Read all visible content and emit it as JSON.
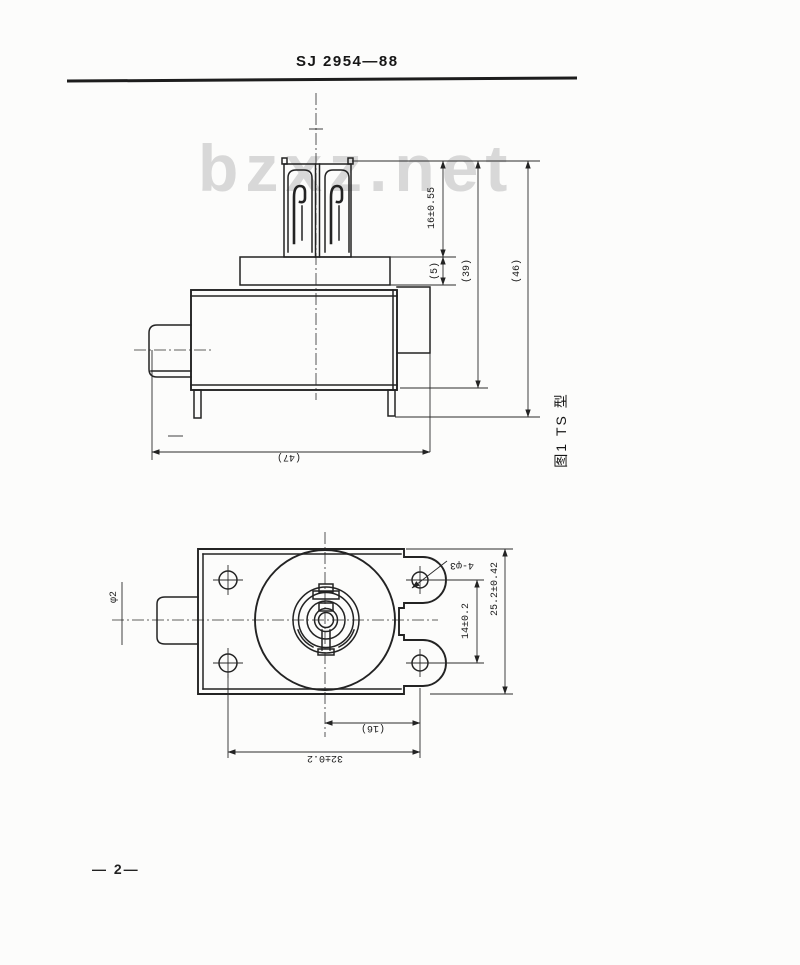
{
  "document": {
    "standard_number": "SJ 2954—88",
    "watermark": "bzxz.net",
    "page_number": "— 2—"
  },
  "figure1": {
    "caption": "图1 TS 型",
    "dims": {
      "terminal_height": "16±0.55",
      "flange_thickness": "(5)",
      "height_39": "(39)",
      "height_46": "(46)",
      "overall_length": "(47)"
    }
  },
  "figure2": {
    "dims": {
      "shaft_dia": "φ2",
      "mounting_holes": "4-φ3",
      "lug_hole_spacing": "14±0.2",
      "plate_width": "25.2±0.42",
      "center_to_hole": "(16)",
      "hole_spacing": "32±0.2"
    }
  }
}
